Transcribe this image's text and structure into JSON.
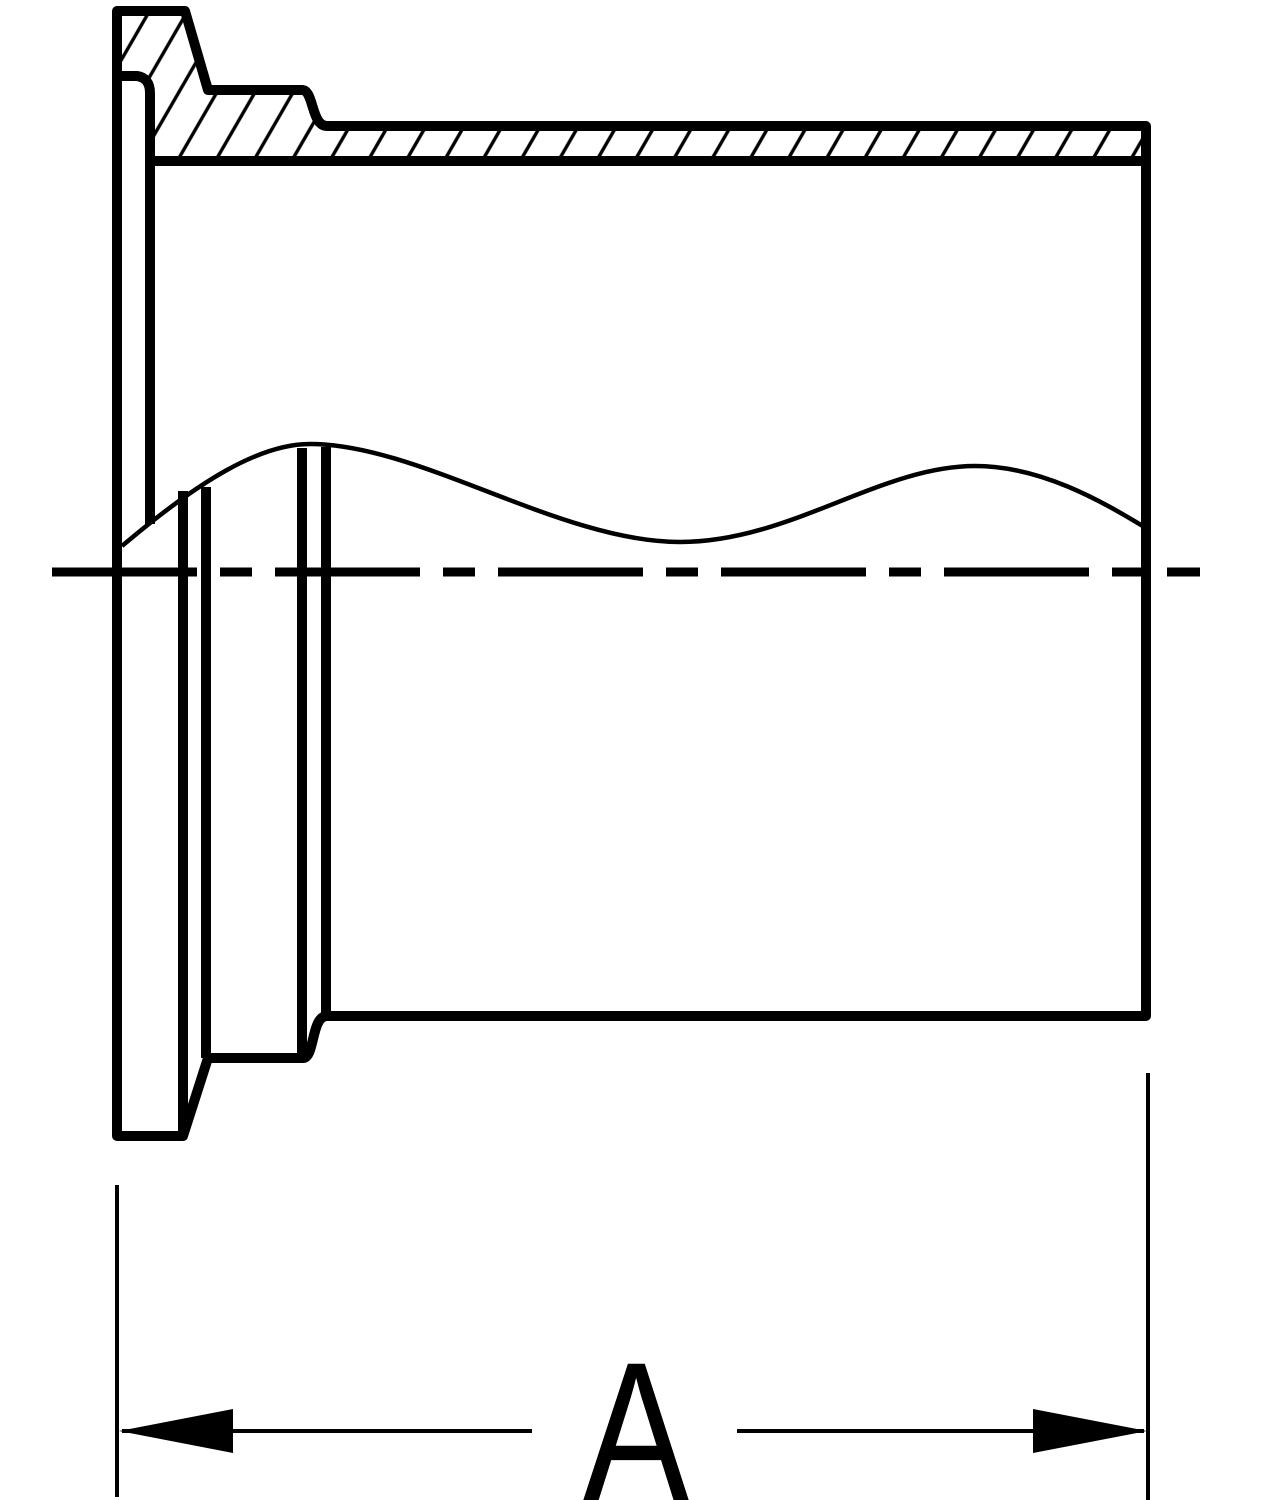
{
  "drawing": {
    "background_color": "#ffffff",
    "line_color": "#000000",
    "dimension_label": "A"
  }
}
